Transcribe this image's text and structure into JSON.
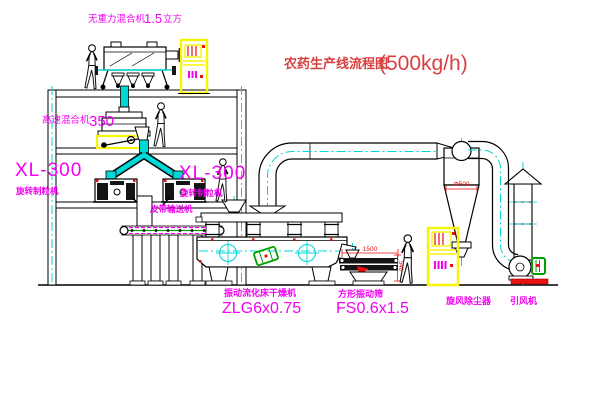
{
  "colors": {
    "magenta": "#f400f4",
    "red": "#e81212",
    "cyan": "#00d8d8",
    "yellow": "#f6f600",
    "green": "#00a000",
    "line": "#000000",
    "titlered": "#d84040"
  },
  "title": {
    "text": "农药生产线流程图",
    "capacity": "(500kg/h)"
  },
  "labels": {
    "gravity_mixer": {
      "name": "无重力混合机",
      "value": "1.5",
      "unit": "立方"
    },
    "high_speed_mixer": {
      "name": "高速混合机",
      "model": "350"
    },
    "granulator_left": {
      "model": "XL-300",
      "name": "旋转制粒机"
    },
    "granulator_right": {
      "model": "XL-300",
      "name": "旋转制粒机"
    },
    "belt_conveyor": {
      "name": "皮带输送机"
    },
    "dryer": {
      "name": "振动流化床干燥机",
      "model": "ZLG6x0.75"
    },
    "screen": {
      "name": "方形振动筛",
      "model": "FS0.6x1.5"
    },
    "cyclone": {
      "name": "旋风除尘器"
    },
    "fan": {
      "name": "引风机"
    }
  },
  "dimensions": {
    "cyclone_inlet": "Φ500",
    "screen_length": "1500",
    "screen_height": "540"
  }
}
